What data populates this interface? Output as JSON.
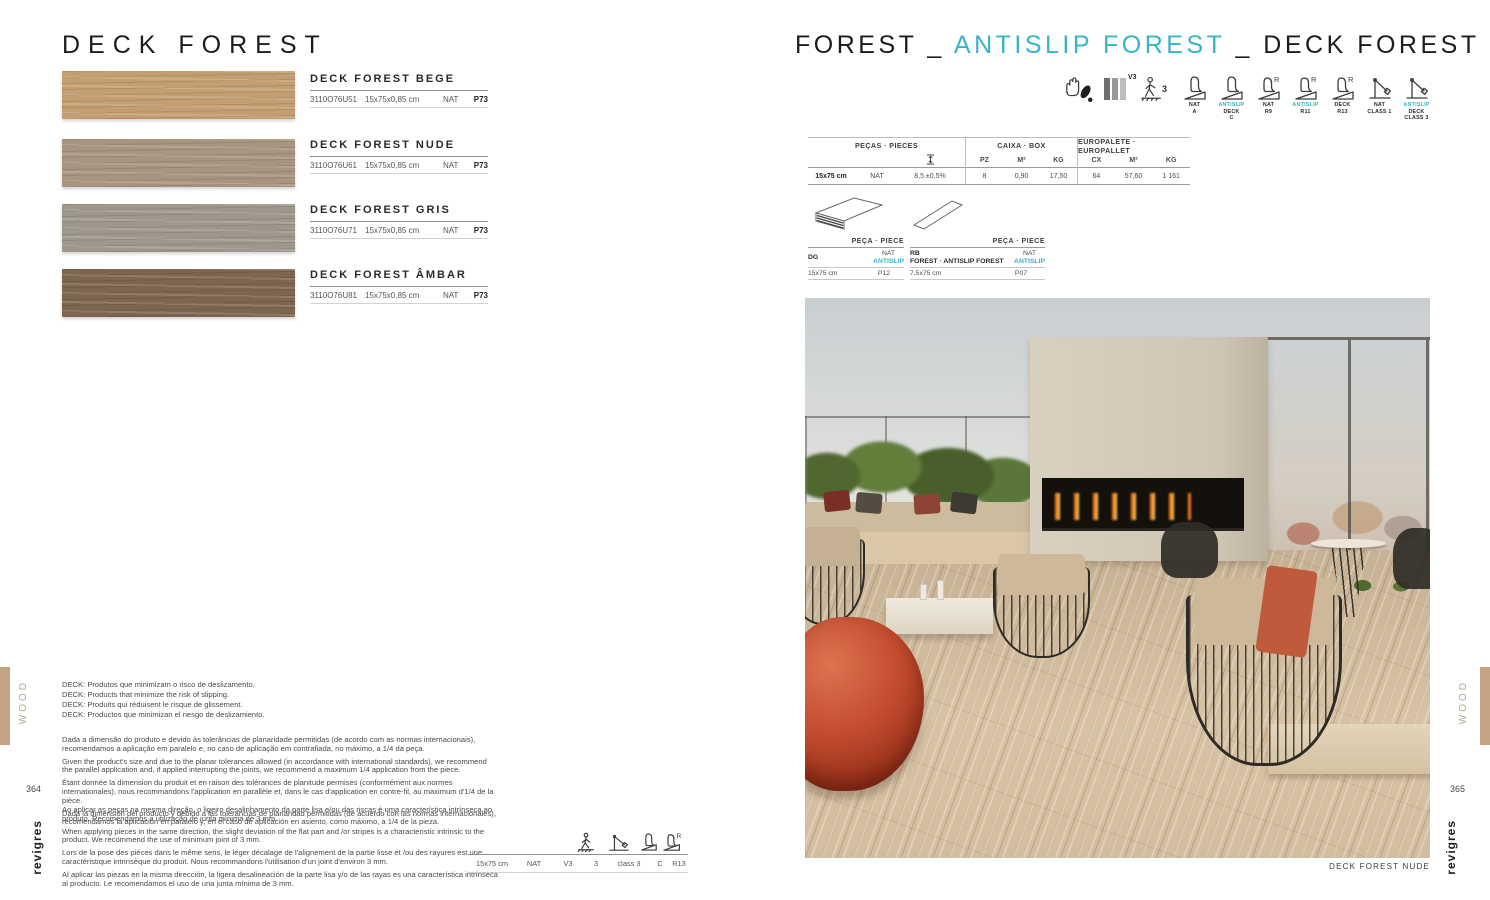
{
  "brand": "revigres",
  "colors": {
    "accent_cyan": "#38b4c8",
    "tan_margin": "#c3a381",
    "swatch_bege": "#c49e72",
    "swatch_nude": "#a9947f",
    "swatch_gris": "#9e978c",
    "swatch_ambar": "#7e654f"
  },
  "left_page": {
    "title": "DECK FOREST",
    "page_number": "364",
    "side_label": "WOOD",
    "products": [
      {
        "name": "DECK FOREST BEGE",
        "code": "3110O76U51",
        "size": "15x75x0,85 cm",
        "finish": "NAT",
        "price": "P73"
      },
      {
        "name": "DECK FOREST NUDE",
        "code": "3110O76U61",
        "size": "15x75x0,85 cm",
        "finish": "NAT",
        "price": "P73"
      },
      {
        "name": "DECK FOREST GRIS",
        "code": "3110O76U71",
        "size": "15x75x0,85 cm",
        "finish": "NAT",
        "price": "P73"
      },
      {
        "name": "DECK FOREST ÂMBAR",
        "code": "3110O76U81",
        "size": "15x75x0,85 cm",
        "finish": "NAT",
        "price": "P73"
      }
    ],
    "deck_notes": [
      "DECK: Produtos que minimizam o risco de deslizamento.",
      "DECK: Products that minimize the risk of slipping.",
      "DECK: Produits qui réduisent le risque de glissement.",
      "DECK: Productos que minimizan el riesgo de deslizamiento."
    ],
    "paragraphs_flatness": [
      "Dada a dimensão do produto e devido às tolerâncias de planaridade permitidas (de acordo com as normas internacionais), recomendamos a aplicação em paralelo e, no caso de aplicação em contrafiada, no máximo, a 1/4 da peça.",
      "Given the product's size and due to the planar tolerances allowed (in accordance with international standards), we recommend the parallel application and, if applied interrupting the joints, we recommend a maximum 1/4 application from the piece.",
      "Étant donnée la dimension du produit et en raison des tolérances de planitude permises (conformément aux normes internationales), nous recommandons l'application en parallèle et, dans le cas d'application en contre-fil, au maximum d'1/4 de la pièce.",
      "Dada la dimensión del producto y debido a las tolerancias de planaridad permitidas (de acuerdo con las normas internacionales), recomendamos la aplicación en paralelo y, en el caso de aplicación en asiento, como máximo, a 1/4 de la pieza."
    ],
    "paragraphs_joint": [
      "Ao aplicar as peças na mesma direção, o ligeiro desalinhamento da parte lisa e/ou das riscas é uma característica intrínseca ao produto. Recomendamos a utilização de junta mínima de 3 mm.",
      "When applying pieces in the same direction, the slight deviation of the flat part and /or stripes is a characteristic intrinsic to the product. We recommend the use of minimum joint of 3 mm.",
      "Lors de la pose des pièces dans le même sens, le léger décalage de l'alignement de la partie lisse et /ou des rayures est une caractéristique intrinsèque du produit. Nous recommandons l'utilisation d'un joint d'environ 3 mm.",
      "Al aplicar las piezas en la misma dirección, la ligera desalineación de la parte lisa y/o de las rayas es una característica intrínseca al producto. Le recomendamos el uso de una junta mínima de 3 mm."
    ],
    "spec_row": [
      "15x75 cm",
      "NAT",
      "V3",
      "3",
      "class 3",
      "C",
      "R13"
    ]
  },
  "right_page": {
    "title_part1": "FOREST",
    "title_sep1": "_",
    "title_part2": "ANTISLIP FOREST",
    "title_sep2": "_",
    "title_part3": "DECK FOREST",
    "page_number": "365",
    "side_label": "WOOD",
    "info_icons": {
      "shade": "V3",
      "traffic": "3"
    },
    "cert_labels": [
      {
        "l1": "NAT",
        "l2": "A"
      },
      {
        "l1": "ANTISLIP",
        "l2": "DECK",
        "l3": "C"
      },
      {
        "l1": "NAT",
        "l2": "R9"
      },
      {
        "l1": "ANTISLIP",
        "l2": "R11"
      },
      {
        "l1": "DECK",
        "l2": "R13"
      },
      {
        "l1": "NAT",
        "l2": "CLASS 1"
      },
      {
        "l1": "ANTISLIP",
        "l2": "DECK",
        "l3": "CLASS 3"
      }
    ],
    "box_table": {
      "group_headers": [
        "PEÇAS · PIECES",
        "CAIXA · BOX",
        "EUROPALETE · EUROPALLET"
      ],
      "sub_headers": [
        "PZ",
        "M²",
        "KG",
        "CX",
        "M²",
        "KG"
      ],
      "row": {
        "size": "15x75 cm",
        "finish": "NAT",
        "thickness": "8,5 ±0,5%",
        "pz": "8",
        "m2_box": "0,90",
        "kg_box": "17,50",
        "cx": "64",
        "m2_pallet": "57,60",
        "kg_pallet": "1 161"
      }
    },
    "pieces": [
      {
        "header": "PEÇA · PIECE",
        "code": "DG",
        "name2": "",
        "fin1": "NAT",
        "fin2": "ANTISLIP",
        "size": "15x75 cm",
        "price": "P12"
      },
      {
        "header": "PEÇA · PIECE",
        "code": "RB",
        "name2": "FOREST · ANTISLIP FOREST",
        "fin1": "NAT",
        "fin2": "ANTISLIP",
        "size": "7,5x75 cm",
        "price": "P07"
      }
    ],
    "photo_caption": "DECK FOREST NUDE"
  }
}
